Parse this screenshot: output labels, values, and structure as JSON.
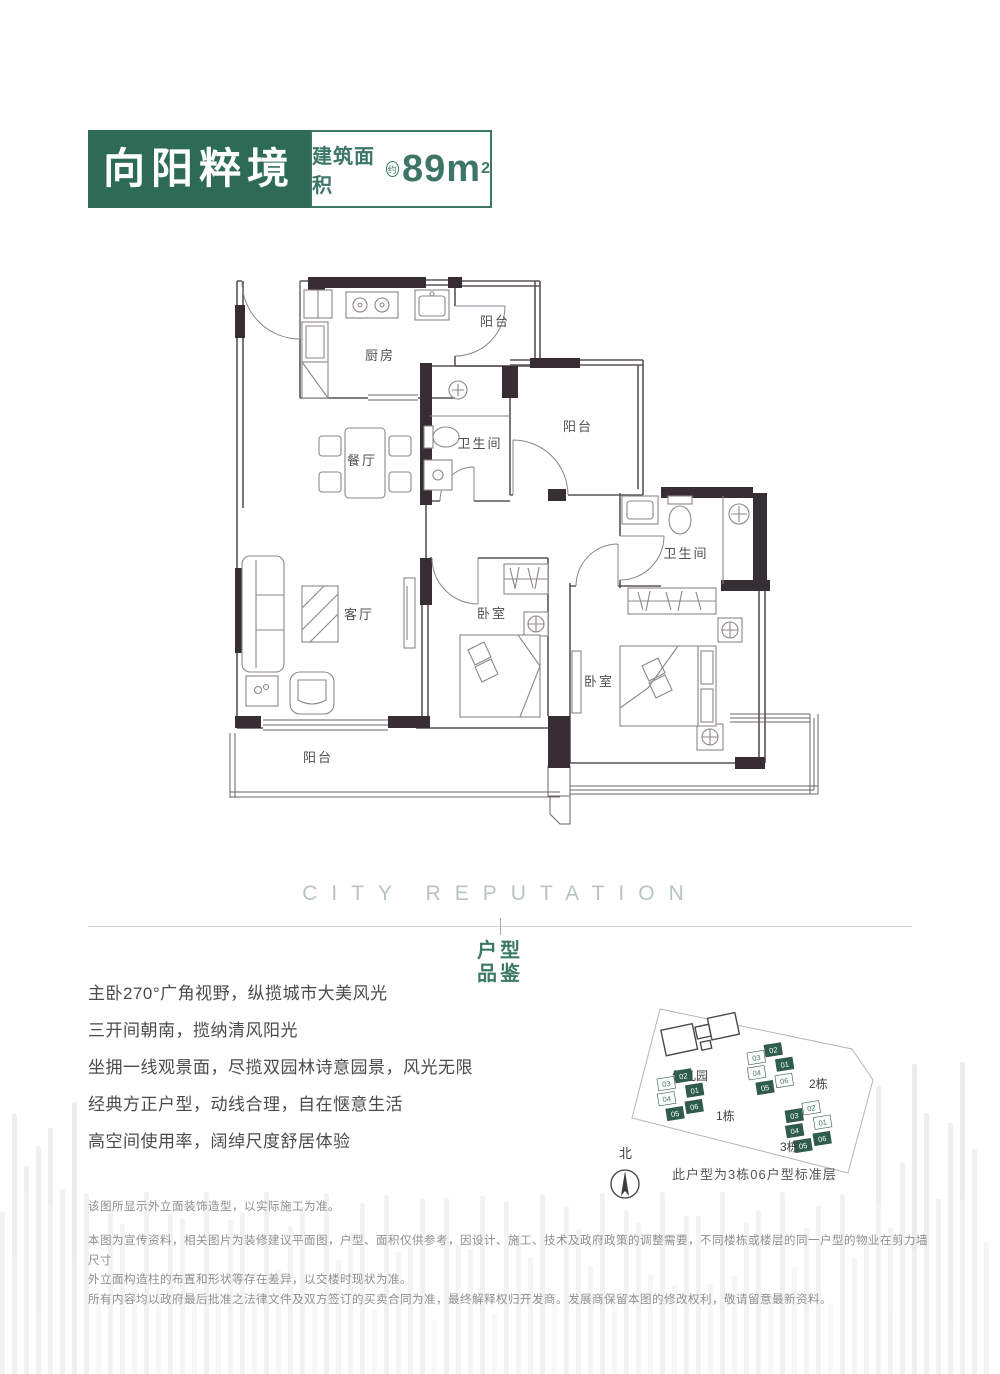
{
  "header": {
    "title": "向阳粹境",
    "area_label": "建筑面积",
    "area_qualifier": "约",
    "area_value": "89",
    "area_unit": "m",
    "area_exponent": "2"
  },
  "plan": {
    "kitchen": "厨房",
    "balcony_top": "阳台",
    "bath_1": "卫生间",
    "dining": "餐厅",
    "balcony_mid": "阳台",
    "bath_2": "卫生间",
    "living": "客厅",
    "bedroom_1": "卧室",
    "bedroom_2": "卧室",
    "balcony_bottom": "阳台"
  },
  "section": {
    "english_title": "CITY REPUTATION",
    "tag_top": "户型",
    "tag_bottom": "品鉴"
  },
  "features": [
    "主卧270°广角视野，纵揽城市大美风光",
    "三开间朝南，揽纳清风阳光",
    "坐拥一线观景面，尽揽双园林诗意园景，风光无限",
    "经典方正户型，动线合理，自在惬意生活",
    "高空间使用率，阔绰尺度舒居体验"
  ],
  "sitemap": {
    "kindergarten_label": "幼儿园",
    "north_label": "北",
    "caption": "此户型为3栋06户型标准层",
    "buildings": [
      {
        "name": "1栋",
        "units": [
          {
            "label": "03",
            "filled": false
          },
          {
            "label": "02",
            "filled": true
          },
          {
            "label": "04",
            "filled": false
          },
          {
            "label": "01",
            "filled": true
          },
          {
            "label": "05",
            "filled": true
          },
          {
            "label": "06",
            "filled": true
          }
        ]
      },
      {
        "name": "2栋",
        "units": [
          {
            "label": "03",
            "filled": false
          },
          {
            "label": "02",
            "filled": true
          },
          {
            "label": "04",
            "filled": false
          },
          {
            "label": "01",
            "filled": true
          },
          {
            "label": "05",
            "filled": true
          },
          {
            "label": "06",
            "filled": false
          }
        ]
      },
      {
        "name": "3栋",
        "units": [
          {
            "label": "03",
            "filled": true
          },
          {
            "label": "02",
            "filled": false
          },
          {
            "label": "04",
            "filled": true
          },
          {
            "label": "01",
            "filled": false
          },
          {
            "label": "05",
            "filled": true
          },
          {
            "label": "06",
            "filled": true
          }
        ]
      }
    ]
  },
  "disclaimer": {
    "line1": "该图所显示外立面装饰造型，以实际施工为准。",
    "lines": [
      "本图为宣传资料，相关图片为装修建议平面图，户型、面积仅供参考，因设计、施工、技术及政府政策的调整需要，不同楼栋或楼层的同一户型的物业在剪力墙尺寸",
      "外立面构造柱的布置和形状等存在差异，以交楼时现状为准。",
      "所有内容均以政府最后批准之法律文件及双方签订的买卖合同为准，最终解释权归开发商。发展商保留本图的修改权利，敬请留意最新资料。"
    ]
  },
  "colors": {
    "brand_green": "#2e6b57",
    "accent_green": "#3c7a64",
    "english_gray": "#b7c4bf",
    "plan_ink": "#362e32"
  }
}
